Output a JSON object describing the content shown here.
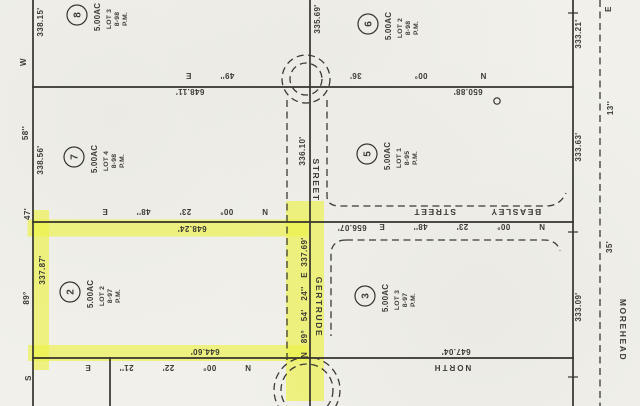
{
  "map": {
    "type": "scanned plat survey map",
    "background_color": "#f1f0ea",
    "ink_color": "#34332d",
    "highlight_color": "#edf148",
    "highlighted_lot": "2"
  },
  "streets": {
    "gertrude_name": "GERTRUDE",
    "gertrude_street_word": "STREET",
    "beasley_label": "BEASLEY STREET",
    "morehead_name": "MOREHEAD"
  },
  "lots": [
    {
      "number": "8",
      "acreage": "5.00AC",
      "lot": "LOT 3",
      "map_ref": "8-98",
      "pm": "P.M."
    },
    {
      "number": "7",
      "acreage": "5.00AC",
      "lot": "LOT 4",
      "map_ref": "8-98",
      "pm": "P.M."
    },
    {
      "number": "6",
      "acreage": "5.00AC",
      "lot": "LOT 2",
      "map_ref": "8-98",
      "pm": "P.M."
    },
    {
      "number": "5",
      "acreage": "5.00AC",
      "lot": "LOT 1",
      "map_ref": "8-95",
      "pm": "P.M."
    },
    {
      "number": "2",
      "acreage": "5.00AC",
      "lot": "LOT 2",
      "map_ref": "8-97",
      "pm": "P.M.",
      "highlighted": true
    },
    {
      "number": "3",
      "acreage": "5.00AC",
      "lot": "LOT 3",
      "map_ref": "8-97",
      "pm": "P.M."
    }
  ],
  "dims": {
    "west_seg_top": "338.15'",
    "west_seg_mid": "338.56'",
    "west_seg_bottom": "337.87'",
    "west_brg_w": "W",
    "west_brg_sec": "58''",
    "west_brg_min": "47'",
    "west_brg_deg": "89°",
    "west_brg_s": "S",
    "north_line_frag": "49'' E",
    "north_line_dist_w": "648.11'",
    "north_line_brg_e": "N 00° 36'",
    "north_line_dist_e": "650.88'",
    "lot2_north_brg": "N 00° 23' 48'' E",
    "lot2_north_dist": "648.24'",
    "beasley_brg": "N 00° 23' 48'' E",
    "beasley_dist": "656.07'",
    "lot2_south_dist": "644.60'",
    "lot2_south_brg": "N 00° 22' 21'' E",
    "south_line_dist_e": "647.04'",
    "south_line_label": "NORTH",
    "gertrude_seg_top": "335.69'",
    "gertrude_seg_mid": "336.10'",
    "gertrude_dist": "337.69'",
    "gertrude_brg": "N 89° 54' 24'' E",
    "east_seg_top": "333.21'",
    "east_seg_mid": "333.63'",
    "east_seg_bottom": "333.09'",
    "morehead_e": "E",
    "morehead_sec": "13''",
    "morehead_min": "35'"
  }
}
